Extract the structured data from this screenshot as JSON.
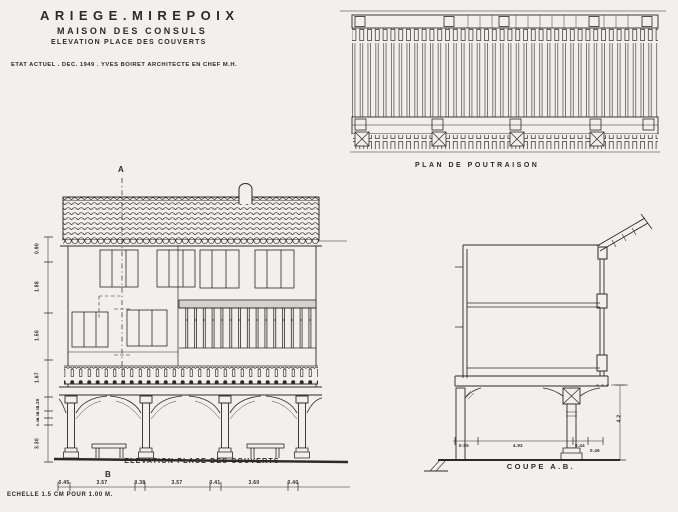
{
  "title_block": {
    "line1": "ARIEGE.MIREPOIX",
    "line2": "MAISON DES CONSULS",
    "line3": "ELEVATION PLACE DES COUVERTS",
    "line4": "ETAT ACTUEL . DEC. 1949 . YVES BOIRET ARCHITECTE EN CHEF M.H."
  },
  "plan": {
    "caption": "PLAN DE POUTRAISON"
  },
  "elevation": {
    "caption": "ELEVATION PLACE DES COUVERTS",
    "marker_top": "A",
    "marker_bottom": "B",
    "bottom_dims": [
      "0.45",
      "3.57",
      "0.38",
      "3.57",
      "0.41",
      "3.60",
      "0.40"
    ],
    "left_dims": [
      "0.90",
      "1.88",
      "1.50",
      "1.67",
      "1.26",
      "0.55",
      "0.38",
      "0.48",
      "3.30"
    ]
  },
  "section": {
    "caption": "COUPE A.B.",
    "bottom_dims": [
      "0.55",
      "4.92",
      "0.44",
      "0.46"
    ],
    "right_dim": "4.2"
  },
  "scale_note": "ECHELLE 1.5 CM POUR 1.00 M.",
  "colors": {
    "paper": "#f2f0ec",
    "ink": "#2b2a26"
  }
}
